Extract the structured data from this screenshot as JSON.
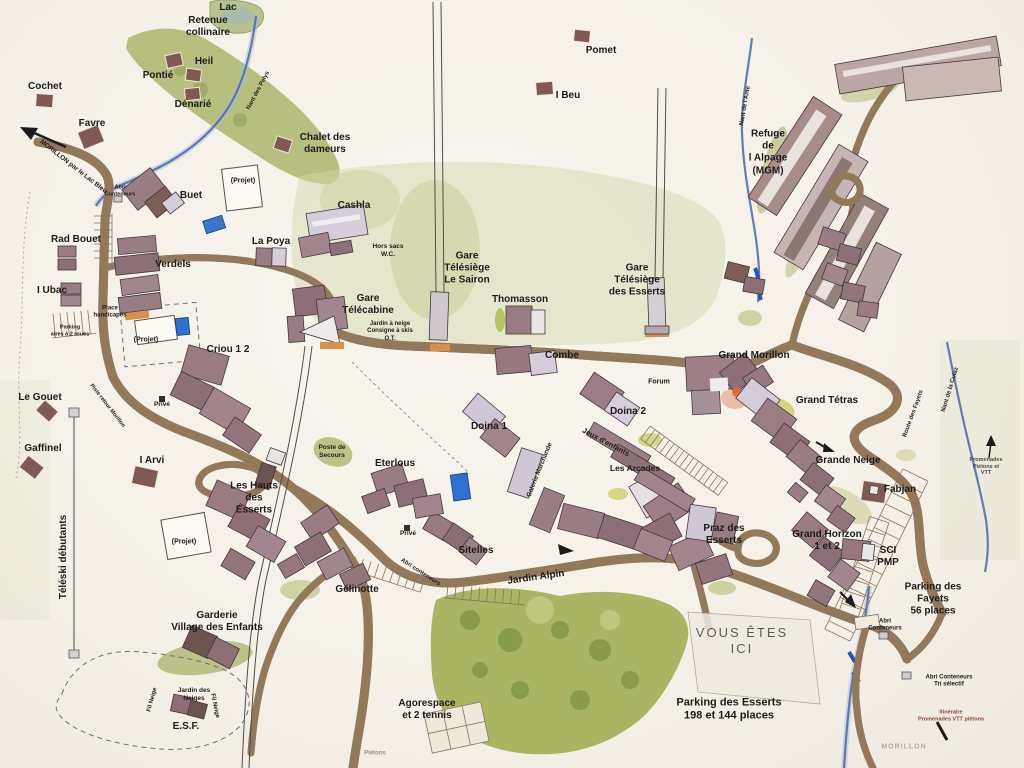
{
  "map": {
    "kind": "hand-drawn resort village plan",
    "you_are_here": "VOUS ÊTES ICI"
  },
  "palette": {
    "paper": "#f7f4ed",
    "road_fill": "#f7f0dd",
    "road_edge": "#93785a",
    "water": "#4668ad",
    "forest": "#a9b55c",
    "building": "#9d7f87",
    "building_light": "#d5cdd9",
    "accent_orange": "#d98f4a",
    "label_ink": "#1d1b1a",
    "itinerary_red": "#8c4038"
  },
  "labels": [
    {
      "name": "label-lac",
      "text": "Lac",
      "x": 228,
      "y": 8
    },
    {
      "name": "label-retenue-collinaire",
      "text": "Retenue\ncollinaire",
      "x": 208,
      "y": 27
    },
    {
      "name": "label-pomet",
      "text": "Pomet",
      "x": 601,
      "y": 51
    },
    {
      "name": "label-heil",
      "text": "Heil",
      "x": 204,
      "y": 62
    },
    {
      "name": "label-pontie",
      "text": "Pontié",
      "x": 158,
      "y": 76
    },
    {
      "name": "label-cochet",
      "text": "Cochet",
      "x": 45,
      "y": 87
    },
    {
      "name": "label-denarie",
      "text": "Dénarié",
      "x": 193,
      "y": 105
    },
    {
      "name": "label-i-beu",
      "text": "I Beu",
      "x": 568,
      "y": 96
    },
    {
      "name": "label-favre",
      "text": "Favre",
      "x": 92,
      "y": 124
    },
    {
      "name": "label-chalet-des-dameurs",
      "text": "Chalet des\ndameurs",
      "x": 325,
      "y": 144
    },
    {
      "name": "label-refuge-alpage",
      "text": "Refuge\nde\nl Alpage\n(MGM)",
      "x": 768,
      "y": 153
    },
    {
      "name": "label-projet-buet",
      "text": "(Projet)",
      "x": 243,
      "y": 182,
      "size": 7
    },
    {
      "name": "label-buet",
      "text": "Buet",
      "x": 191,
      "y": 196
    },
    {
      "name": "label-cashla",
      "text": "Cashla",
      "x": 354,
      "y": 206
    },
    {
      "name": "label-la-poya",
      "text": "La Poya",
      "x": 271,
      "y": 242
    },
    {
      "name": "label-rad-bouet",
      "text": "Rad Bouet",
      "x": 76,
      "y": 240
    },
    {
      "name": "label-hors-sacs-wc",
      "text": "Hors sacs\nW.C.",
      "x": 388,
      "y": 251,
      "size": 6.5,
      "weight": 600
    },
    {
      "name": "label-verdels",
      "text": "Verdels",
      "x": 173,
      "y": 265
    },
    {
      "name": "label-gare-telesiege-sairon",
      "text": "Gare\nTélésiège\nLe Sairon",
      "x": 467,
      "y": 269
    },
    {
      "name": "label-gare-telesiege-esserts",
      "text": "Gare\nTélésiège\ndes Esserts",
      "x": 637,
      "y": 281
    },
    {
      "name": "label-i-ubac",
      "text": "I Ubac",
      "x": 52,
      "y": 291
    },
    {
      "name": "label-thomasson",
      "text": "Thomasson",
      "x": 520,
      "y": 300
    },
    {
      "name": "label-gare-telecabine",
      "text": "Gare\nTélécabine",
      "x": 368,
      "y": 305
    },
    {
      "name": "label-place-handicapes",
      "text": "Place\nhandicapés",
      "x": 110,
      "y": 313,
      "size": 6,
      "weight": 600
    },
    {
      "name": "label-services-ot",
      "text": "Jardin à neige\nConsigne à skis\nO.T.",
      "x": 390,
      "y": 332,
      "size": 6,
      "weight": 600
    },
    {
      "name": "label-parking-2-roues",
      "text": "Parking\naires à 2 roues",
      "x": 70,
      "y": 331,
      "size": 5.5,
      "weight": 600
    },
    {
      "name": "label-projet-verdels",
      "text": "(Projet)",
      "x": 146,
      "y": 341,
      "size": 7
    },
    {
      "name": "label-criou-1-2",
      "text": "Criou 1 2",
      "x": 228,
      "y": 350
    },
    {
      "name": "label-combe",
      "text": "Combe",
      "x": 562,
      "y": 356
    },
    {
      "name": "label-grand-morillon",
      "text": "Grand Morillon",
      "x": 754,
      "y": 356
    },
    {
      "name": "label-forum",
      "text": "Forum",
      "x": 659,
      "y": 383,
      "size": 7,
      "weight": 600
    },
    {
      "name": "label-le-gouet",
      "text": "Le Gouet",
      "x": 40,
      "y": 398
    },
    {
      "name": "label-grand-tetras",
      "text": "Grand Tétras",
      "x": 827,
      "y": 401
    },
    {
      "name": "label-prive-nord",
      "text": "Privé",
      "x": 162,
      "y": 405,
      "size": 6.5,
      "weight": 600
    },
    {
      "name": "label-piste-retour",
      "text": "Piste retour Morillon",
      "x": 107,
      "y": 406,
      "rot": 52,
      "size": 5.5,
      "weight": 600
    },
    {
      "name": "label-doina-2",
      "text": "Doina 2",
      "x": 628,
      "y": 412
    },
    {
      "name": "label-nant-des-pelys",
      "text": "Nant des Pelys",
      "x": 259,
      "y": 91,
      "rot": -62,
      "size": 6,
      "weight": 600
    },
    {
      "name": "label-doina-1",
      "text": "Doina 1",
      "x": 489,
      "y": 427
    },
    {
      "name": "label-jeux-denfants",
      "text": "Jeux d'enfants",
      "x": 606,
      "y": 442,
      "rot": 28,
      "size": 7.5
    },
    {
      "name": "label-gaffinel",
      "text": "Gaffinel",
      "x": 43,
      "y": 449
    },
    {
      "name": "label-poste-de-secours",
      "text": "Poste de\nSecours",
      "x": 332,
      "y": 452,
      "size": 6.5,
      "weight": 600
    },
    {
      "name": "label-grande-neige",
      "text": "Grande Neige",
      "x": 848,
      "y": 461
    },
    {
      "name": "label-i-arvi",
      "text": "I Arvi",
      "x": 152,
      "y": 461
    },
    {
      "name": "label-eterlous",
      "text": "Eterlous",
      "x": 395,
      "y": 464
    },
    {
      "name": "label-promenades-pietons-vtt",
      "text": "Promenades\nPiétons et VTT",
      "x": 986,
      "y": 467,
      "size": 5.5,
      "weight": 600,
      "color": "#4a4a48"
    },
    {
      "name": "label-les-arcades",
      "text": "Les Arcades",
      "x": 635,
      "y": 468,
      "size": 8.5
    },
    {
      "name": "label-galerie-marchande",
      "text": "Galerie Marchande",
      "x": 540,
      "y": 470,
      "rot": -68,
      "size": 6.5,
      "weight": 600
    },
    {
      "name": "label-fabjan",
      "text": "Fabjan",
      "x": 900,
      "y": 490
    },
    {
      "name": "label-les-hauts-des-esserts",
      "text": "Les Hauts\ndes\nEsserts",
      "x": 254,
      "y": 499
    },
    {
      "name": "label-route-des-fayets",
      "text": "Route des Fayets",
      "x": 914,
      "y": 414,
      "rot": -70,
      "size": 6,
      "weight": 600
    },
    {
      "name": "label-nant-de-la-culaz",
      "text": "Nant de la Culaz",
      "x": 951,
      "y": 390,
      "rot": -73,
      "size": 6,
      "weight": 600
    },
    {
      "name": "label-nant-de-l-ante",
      "text": "Nant de l'Ante",
      "x": 746,
      "y": 106,
      "rot": -80,
      "size": 6,
      "weight": 600
    },
    {
      "name": "label-morillon-par-le-lac",
      "text": "MORILLON par le Lac Bleu",
      "x": 73,
      "y": 167,
      "rot": 38,
      "size": 6.5,
      "weight": 600
    },
    {
      "name": "label-teleski-debutants",
      "text": "Téléski débutants",
      "x": 64,
      "y": 557,
      "rot": -90
    },
    {
      "name": "label-praz-des-esserts",
      "text": "Praz des\nEsserts",
      "x": 724,
      "y": 535
    },
    {
      "name": "label-grand-horizon",
      "text": "Grand Horizon\n1 et 2",
      "x": 827,
      "y": 541
    },
    {
      "name": "label-projet-sud",
      "text": "(Projet)",
      "x": 184,
      "y": 543,
      "size": 7
    },
    {
      "name": "label-prive-sud",
      "text": "Privé",
      "x": 408,
      "y": 534,
      "size": 6.5,
      "weight": 600
    },
    {
      "name": "label-sitelles",
      "text": "Sitelles",
      "x": 476,
      "y": 551
    },
    {
      "name": "label-sci-pmp",
      "text": "SCI\nPMP",
      "x": 888,
      "y": 557
    },
    {
      "name": "label-abri-conteneurs-route",
      "text": "Abri conteneurs",
      "x": 420,
      "y": 573,
      "rot": 33,
      "size": 6,
      "weight": 600
    },
    {
      "name": "label-jardin-alpin",
      "text": "Jardin Alpin",
      "x": 536,
      "y": 578,
      "rot": -8
    },
    {
      "name": "label-gelinotte",
      "text": "Gélinotte",
      "x": 357,
      "y": 590
    },
    {
      "name": "label-parking-des-fayets",
      "text": "Parking des\nFayets\n56 places",
      "x": 933,
      "y": 600
    },
    {
      "name": "label-garderie",
      "text": "Garderie\nVillage des Enfants",
      "x": 217,
      "y": 622
    },
    {
      "name": "label-abri-conteneurs-fayets",
      "text": "Abri\nConteneurs",
      "x": 885,
      "y": 626,
      "size": 6,
      "weight": 600
    },
    {
      "name": "label-vous-etes-ici",
      "text": "VOUS ÊTES\nICI",
      "x": 742,
      "y": 641,
      "size": 13,
      "weight": 400,
      "color": "#5c5a56",
      "spacing": 2
    },
    {
      "name": "label-abri-tri-selectif",
      "text": "Abri Conteneurs\nTri sélectif",
      "x": 949,
      "y": 682,
      "size": 6,
      "weight": 600
    },
    {
      "name": "label-jardin-des-neiges",
      "text": "Jardin des\nNeiges",
      "x": 194,
      "y": 695,
      "size": 6.5,
      "weight": 600
    },
    {
      "name": "label-fil-neige-ouest",
      "text": "Fil Neige",
      "x": 153,
      "y": 700,
      "rot": -75,
      "size": 6,
      "weight": 600
    },
    {
      "name": "label-fil-neige-est",
      "text": "Fil Neige",
      "x": 214,
      "y": 706,
      "rot": 78,
      "size": 6,
      "weight": 600
    },
    {
      "name": "label-agorespace",
      "text": "Agorespace\net 2 tennis",
      "x": 427,
      "y": 710
    },
    {
      "name": "label-parking-des-esserts",
      "text": "Parking des Esserts\n198 et 144 places",
      "x": 729,
      "y": 710,
      "size": 11
    },
    {
      "name": "label-itineraire-vtt",
      "text": "Itinéraire\nPromenades VTT piétons",
      "x": 951,
      "y": 716,
      "size": 5.5,
      "weight": 600,
      "color": "#8c4038"
    },
    {
      "name": "label-esf",
      "text": "E.S.F.",
      "x": 186,
      "y": 727
    },
    {
      "name": "label-morillon-bas",
      "text": "MORILLON",
      "x": 904,
      "y": 748,
      "size": 7,
      "weight": 600,
      "color": "#b3aa99",
      "spacing": 1
    },
    {
      "name": "label-pietons",
      "text": "Piétons",
      "x": 375,
      "y": 754,
      "size": 6,
      "weight": 600,
      "color": "#98917f"
    },
    {
      "name": "label-abri-conteneurs-buet",
      "text": "Abri\nConteneurs",
      "x": 120,
      "y": 191,
      "size": 5.5,
      "weight": 600
    }
  ]
}
